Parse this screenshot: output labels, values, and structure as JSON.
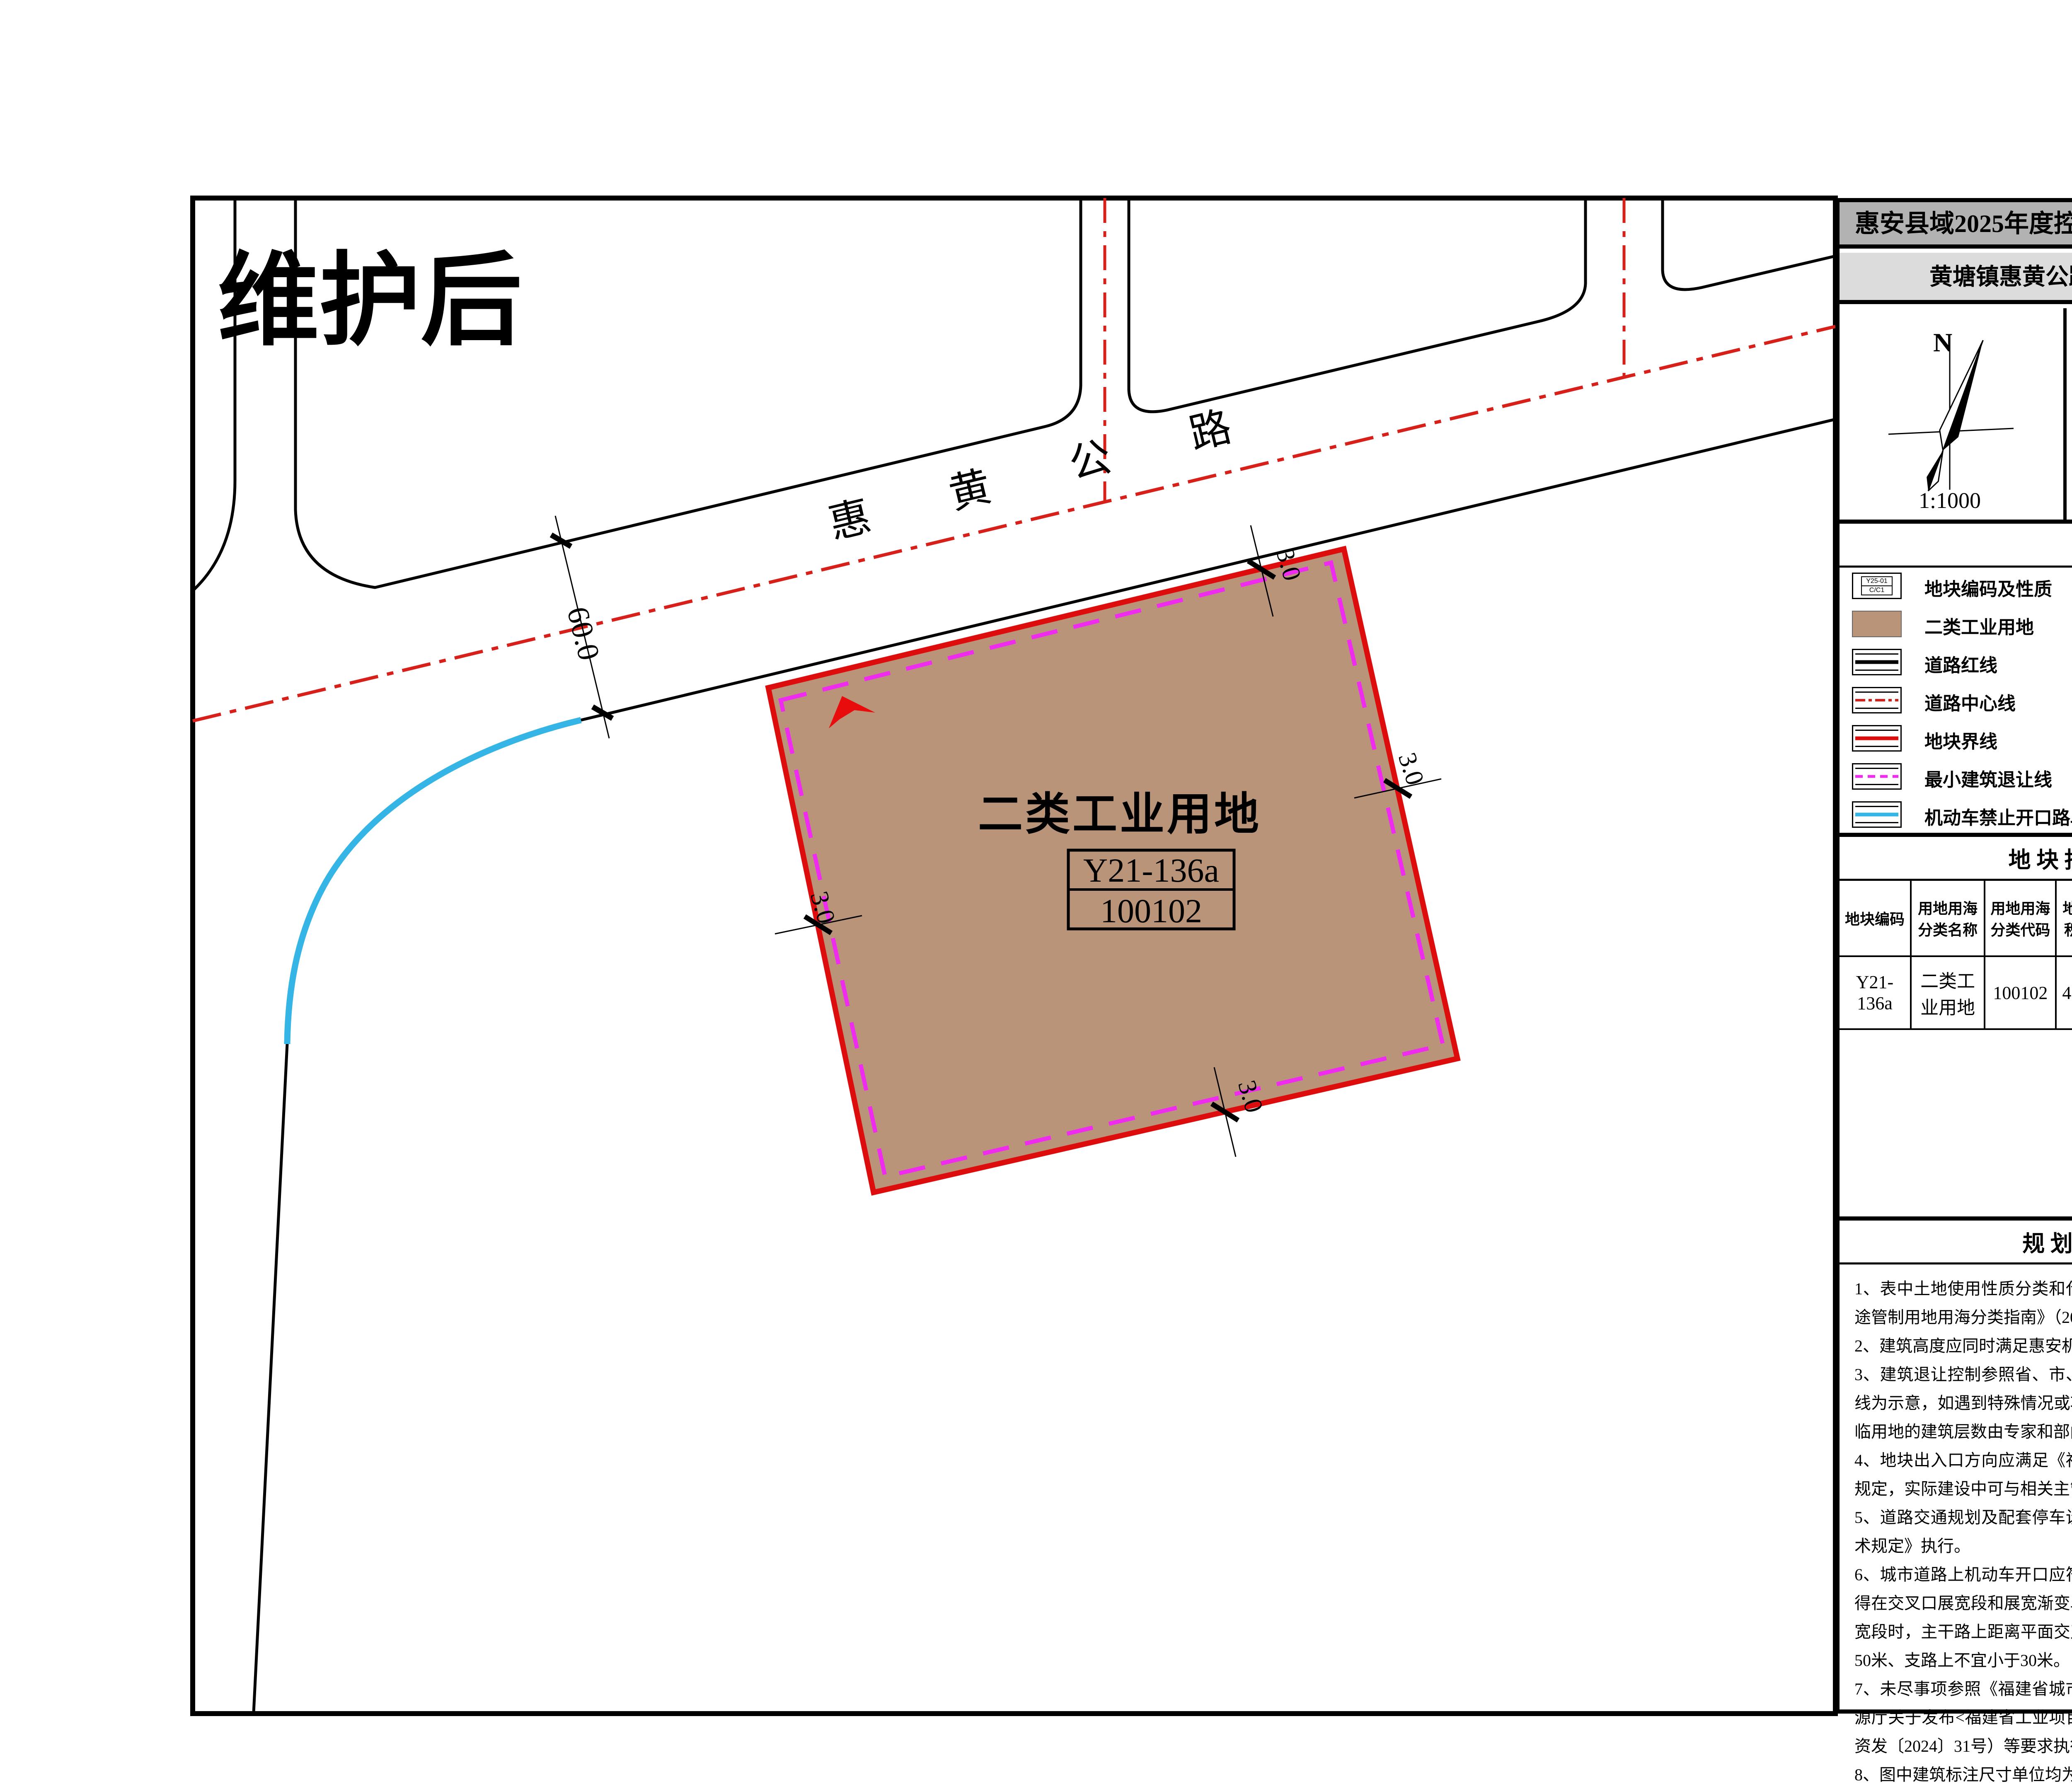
{
  "page": {
    "title_line1": "惠安县域2025年度控规动态维护（第三批次）",
    "title_line2": "黄塘镇惠黄公路南侧地块规划图则"
  },
  "map": {
    "corner_label": "维护后",
    "road_name": "惠黄公路",
    "road_chars": [
      "惠",
      "黄",
      "公",
      "路"
    ],
    "parcel": {
      "use_label": "二类工业用地",
      "code": "Y21-136a",
      "class_code": "100102"
    },
    "dims": {
      "road_width": "60.0",
      "setback": "3.0"
    }
  },
  "compass": {
    "north": "N",
    "scale": "1:1000"
  },
  "location": {
    "caption": "位置示意"
  },
  "legend": {
    "title": "图  例",
    "left": [
      {
        "label": "地块编码及性质",
        "code_top": "Y25-01",
        "code_bottom": "C/C1"
      },
      {
        "label": "二类工业用地"
      },
      {
        "label": "道路红线"
      },
      {
        "label": "道路中心线"
      },
      {
        "label": "地块界线"
      },
      {
        "label": "最小建筑退让线"
      },
      {
        "label": "机动车禁止开口路段"
      }
    ],
    "right": [
      {
        "label": "界点坐标",
        "line1": "X=2727850.785",
        "line2": "Y=503301.803"
      },
      {
        "label": "转弯半径标注",
        "text": "R20"
      },
      {
        "label": "尺寸标注",
        "text": "10.0"
      },
      {
        "label": "机动车出入口"
      },
      {
        "label": "规划标高",
        "text": "29.00"
      },
      {
        "label": "坡度、坡向",
        "top": "1.0%",
        "bottom": "200.20"
      }
    ]
  },
  "table": {
    "title": "地 块 指 标 一 览 表",
    "columns": [
      "地块编码",
      "用地用海分类名称",
      "用地用海分类代码",
      "地块面积(m²)",
      "容积率",
      "建筑系数(%)",
      "建筑限高(m)",
      "绿地率(%)",
      "出入口方向"
    ],
    "row": [
      "Y21-136a",
      "二类工业用地",
      "100102",
      "42167",
      "1.35-3.0",
      "≥40",
      "≤50",
      "—",
      "N"
    ]
  },
  "notes": {
    "title": "规 划 控 制 条 文",
    "items": [
      "1、表中土地使用性质分类和代码均采用《国土空间调查、规划、用途管制用地用海分类指南》（2023）。",
      "2、建筑高度应同时满足惠安机场净空保护要求。",
      "3、建筑退让控制参照省、市、县相关技术规定执行，图则中建筑退线为示意，如遇到特殊情况或项目建设需要，实际后退线结合道路、临用地的建筑层数由专家和部门联合审查论证确定。",
      "4、地块出入口方向应满足《福建省城市规划管理技术规定》的相关规定，实际建设中可与相关主管单位协商。",
      "5、道路交通规划及配套停车设施规划参照《福建省城市规划管理技术规定》执行。",
      "6、城市道路上机动车开口应符合下列规定：交叉口有展宽段时，不得在交叉口展宽段和展宽渐变段范围内设置机动车开口；交叉口无展宽段时，主干路上距离平面交叉口不应小于60米、次干路上不应小于50米、支路上不宜小于30米。",
      "7、未尽事项参照《福建省城市规划管理技术规定》、《福建省自然资源厅关于发布<福建省工业项目建设用地控制指标>的通知》（闽自然资发〔2024〕31号）等要求执行。",
      "8、图中建筑标注尺寸单位均为“米”。"
    ]
  },
  "colors": {
    "parcel_brown": "#b99478",
    "boundary_red": "#de0d0d",
    "centerline_red": "#d8201a",
    "setback_magenta": "#f02bf0",
    "no_opening_cyan": "#35b5e5",
    "header_gray": "#b2b2b2",
    "subheader_gray": "#dcdcdc"
  }
}
